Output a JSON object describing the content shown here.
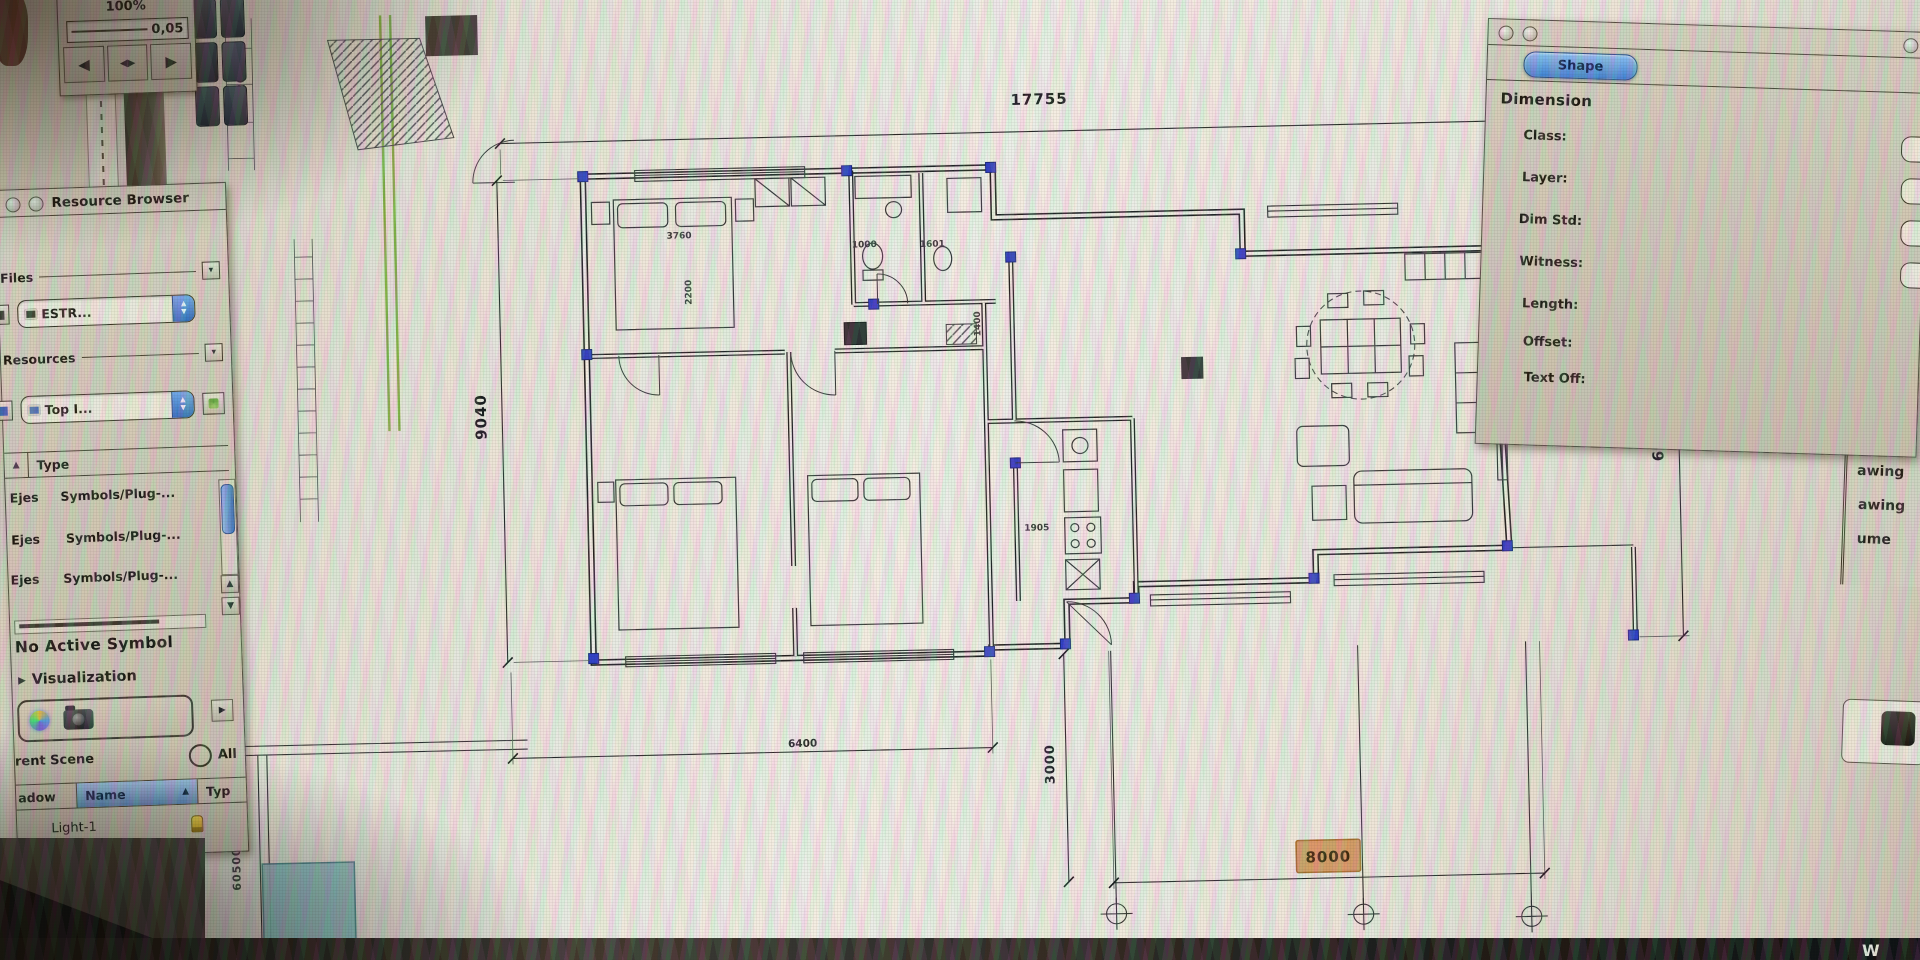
{
  "icons": {
    "dropdown": "▾",
    "up": "▲",
    "down": "▼",
    "left": "◀",
    "right": "▶",
    "sort_asc": "▲",
    "play": "▶"
  },
  "nav_widget": {
    "zoom_percent": "100%",
    "scale_value": "0,05"
  },
  "resource_browser": {
    "title": "Resource Browser",
    "files_label": "Files",
    "files_combo": "ESTR...",
    "resources_label": "Resources",
    "resources_combo": "Top I...",
    "type_header": "Type",
    "rows": [
      {
        "name": "Ejes",
        "type": "Symbols/Plug-..."
      },
      {
        "name": "Ejes",
        "type": "Symbols/Plug-..."
      },
      {
        "name": "Ejes",
        "type": "Symbols/Plug-..."
      }
    ],
    "no_active_symbol": "No Active Symbol",
    "visualization_label": "Visualization",
    "scene_label": "rent Scene",
    "all_label": "All",
    "col_shadow": "adow",
    "col_name": "Name",
    "col_type": "Typ",
    "light_row": "Light-1"
  },
  "dimension_panel": {
    "tab_shape": "Shape",
    "title": "Dimension",
    "field_class": "Class:",
    "field_layer": "Layer:",
    "field_dim_std": "Dim Std:",
    "field_witness": "Witness:",
    "field_length": "Length:",
    "field_offset": "Offset:",
    "field_text_off": "Text Off:"
  },
  "right_edge_list": {
    "items": [
      "awing",
      "awing",
      "awing",
      "ume"
    ]
  },
  "plan": {
    "dim_total_width": "17755",
    "dim_left_height": "9040",
    "dim_right_height": "6900",
    "dim_terrace_depth": "3000",
    "dim_selected": "8000",
    "dim_bottom_left": "6400",
    "dim_bed_width": "3760",
    "dim_bed_length": "2200",
    "dim_bath_1": "1000",
    "dim_bath_2": "1601",
    "dim_wall": "1400",
    "dim_kitchen": "1905",
    "survey_top": "620000",
    "survey_mid": "610000",
    "survey_bottom": "605000",
    "selected_color": "#d89a5f"
  },
  "bottom_bar": {
    "fragment": "W"
  }
}
